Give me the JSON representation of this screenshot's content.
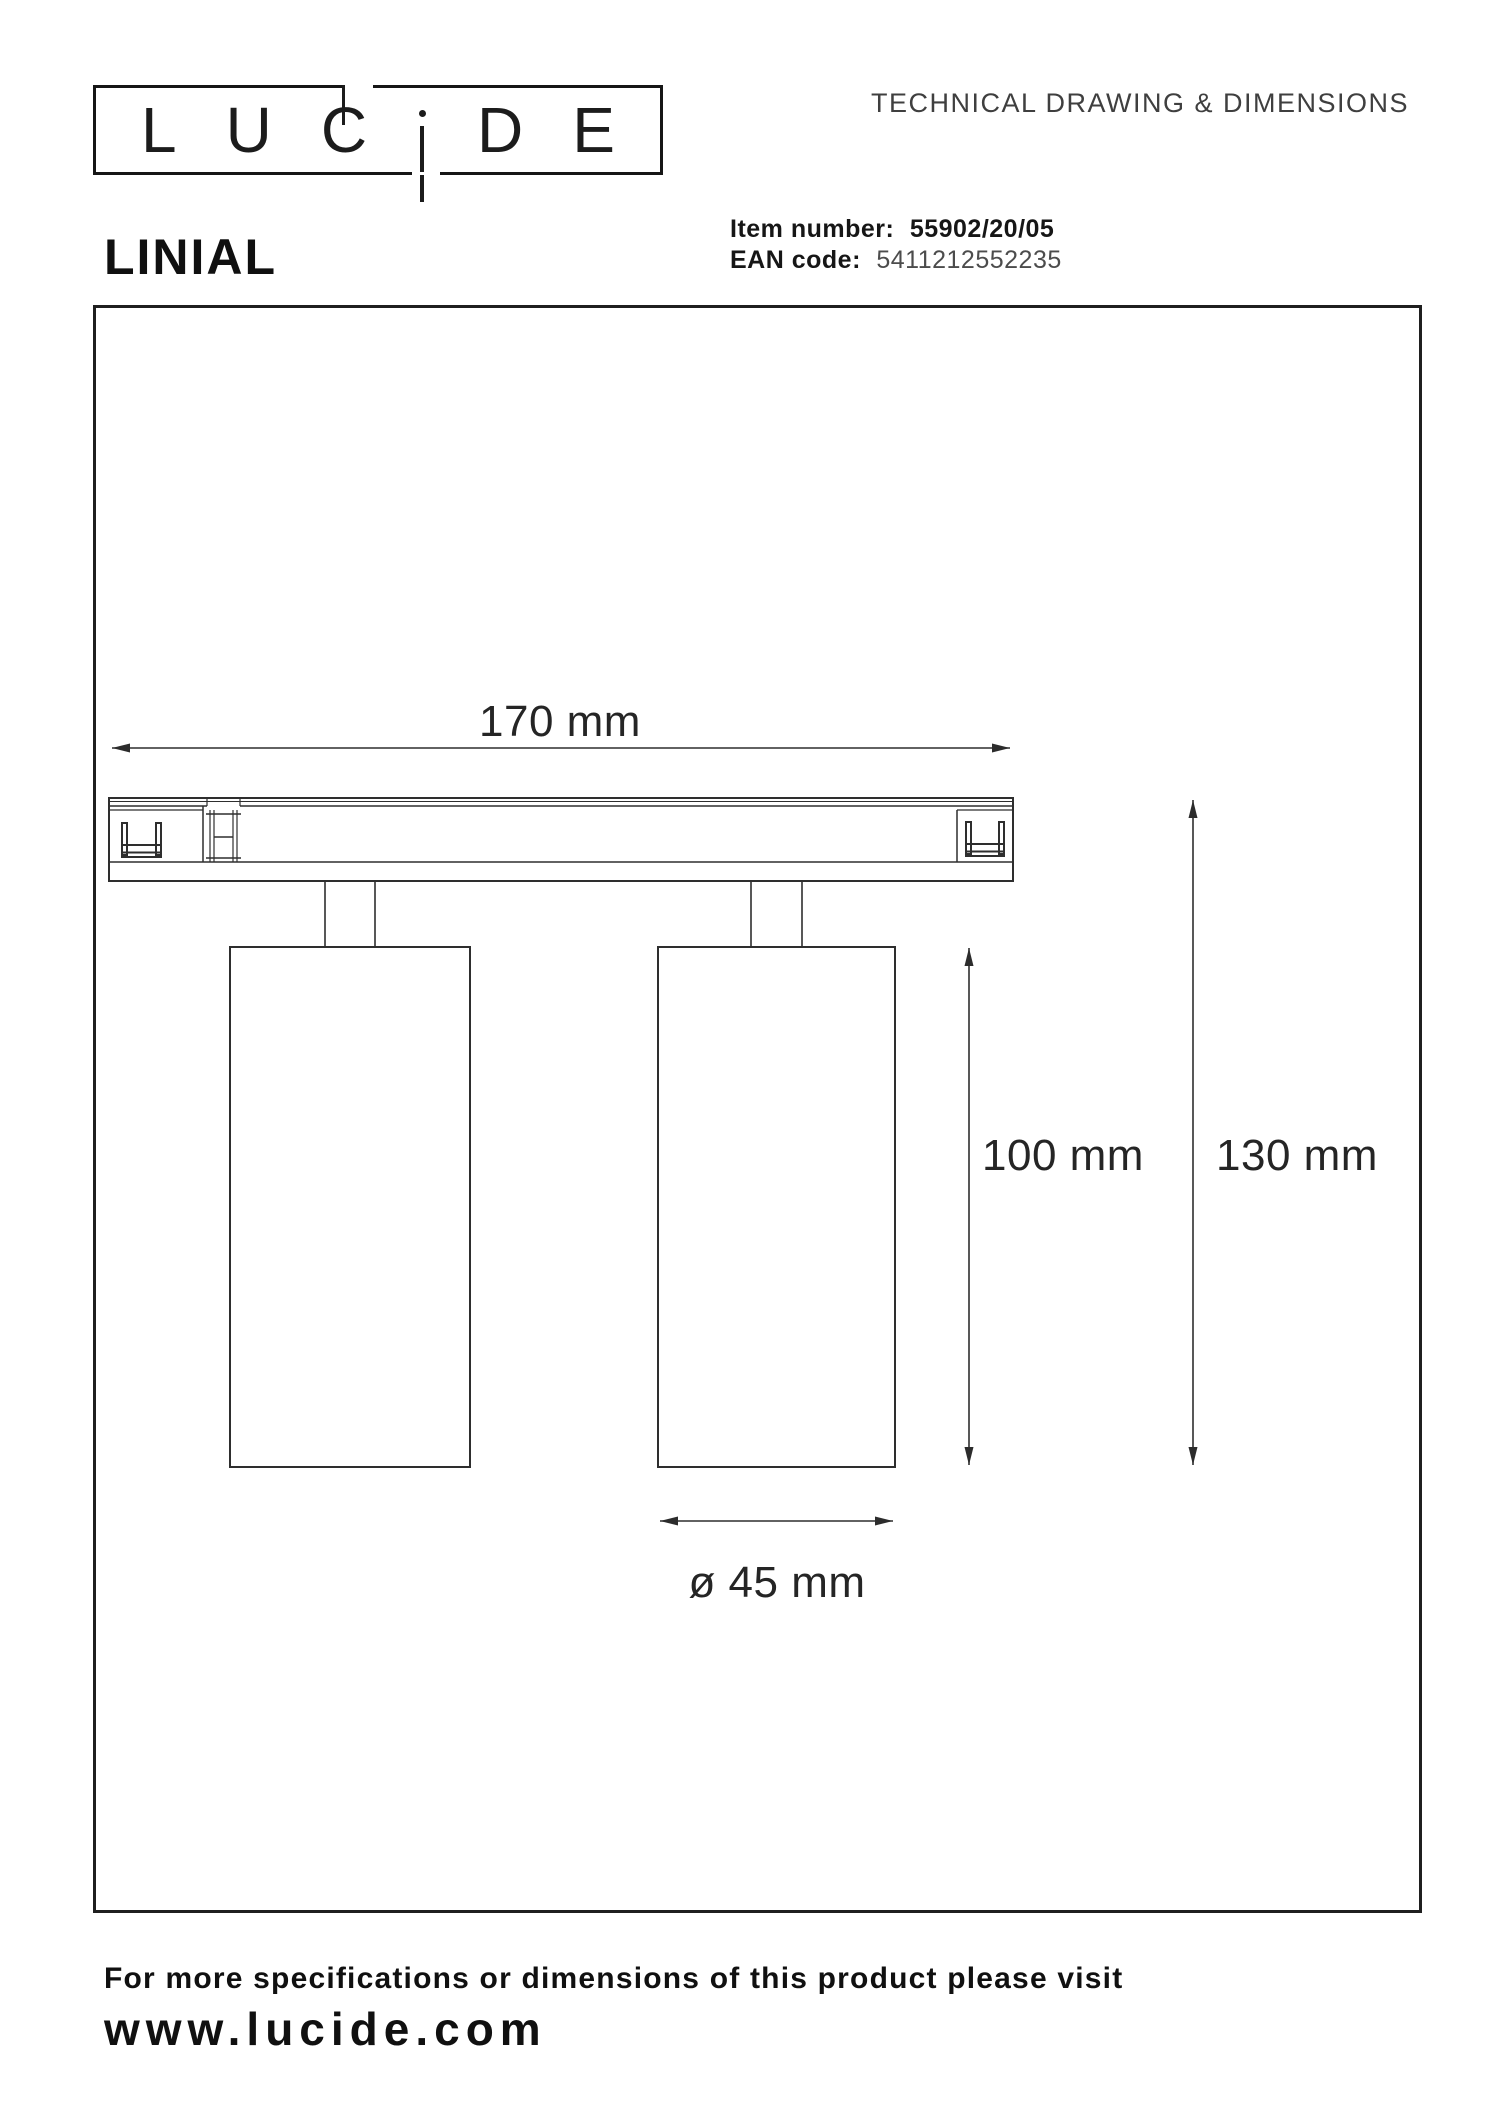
{
  "header": {
    "logo": {
      "letters": [
        "L",
        "U",
        "C",
        "i",
        "D",
        "E"
      ]
    },
    "doc_title": "TECHNICAL DRAWING & DIMENSIONS"
  },
  "product": {
    "name": "LINIAL",
    "item_number_label": "Item number:",
    "item_number_value": "55902/20/05",
    "ean_label": "EAN code:",
    "ean_value": "5411212552235"
  },
  "drawing": {
    "type": "technical-drawing",
    "views": [
      "front view of track rail with two cylindrical spots"
    ],
    "dimensions": {
      "track_width": "170 mm",
      "spot_height": "100 mm",
      "total_height": "130 mm",
      "spot_diameter": "ø 45 mm"
    }
  },
  "footer": {
    "note": "For more specifications or dimensions of this product please visit",
    "website": "www.lucide.com"
  },
  "colors": {
    "ink": "#1c1c1c",
    "line": "#2e2e2e",
    "muted": "#4c4c4c"
  }
}
